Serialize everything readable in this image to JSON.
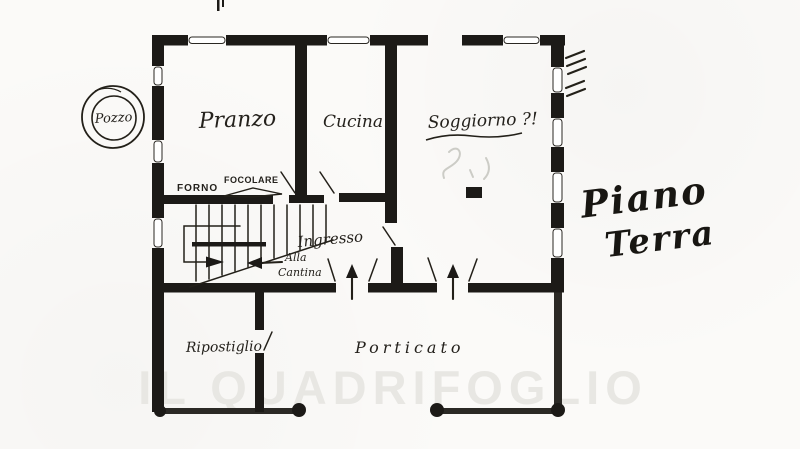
{
  "document": {
    "kind": "hand-drawn floor plan scan",
    "language": "Italian"
  },
  "title": {
    "line1": "Piano",
    "line2": "Terra"
  },
  "watermark": "IL QUADRIFOGLIO",
  "well": {
    "label": "Pozzo"
  },
  "rooms": {
    "pranzo": "Pranzo",
    "cucina": "Cucina",
    "soggiorno": "Soggiorno ?!",
    "ingresso": "Ingresso",
    "ripostiglio": "Ripostiglio",
    "porticato": "Porticato"
  },
  "annotations": {
    "forno": "FORNO",
    "focolare": "FOCOLARE",
    "alla_cantina_line1": "Alla",
    "alla_cantina_line2": "Cantina"
  },
  "colors": {
    "ink": "#1c1a17",
    "paper": "#fbfaf8",
    "watermark_gray": "#e8e7e3"
  }
}
